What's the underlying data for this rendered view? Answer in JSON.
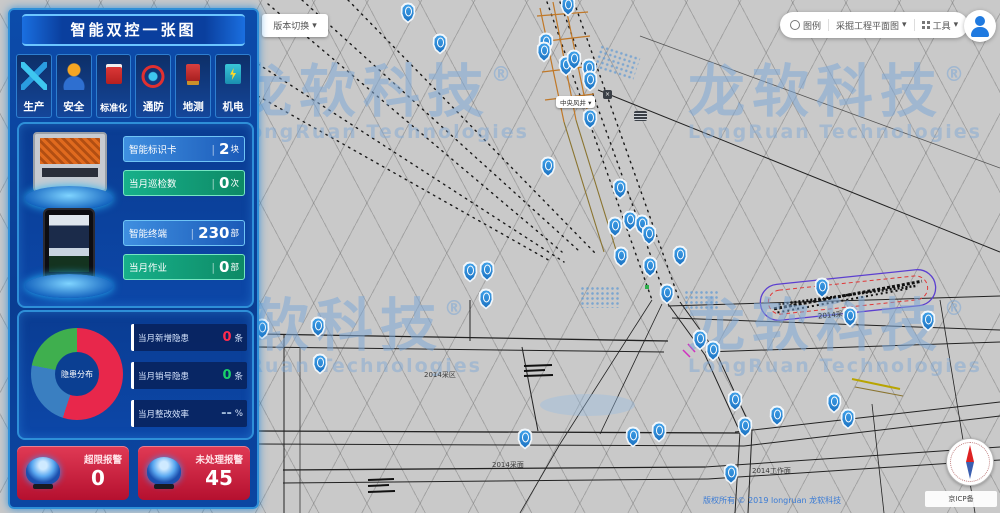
{
  "app": {
    "title": "智能双控一张图"
  },
  "sidebar": {
    "modules": [
      {
        "label": "生产",
        "icon": "production-icon"
      },
      {
        "label": "安全",
        "icon": "safety-icon"
      },
      {
        "label": "标准化",
        "icon": "standardization-icon"
      },
      {
        "label": "通防",
        "icon": "ventilation-icon"
      },
      {
        "label": "地测",
        "icon": "geology-icon"
      },
      {
        "label": "机电",
        "icon": "electromechanical-icon"
      }
    ],
    "device_stats": [
      {
        "label": "智能标识卡",
        "divider": "|",
        "value": "2",
        "unit": "块"
      },
      {
        "label": "当月巡检数",
        "divider": "|",
        "value": "0",
        "unit": "次"
      },
      {
        "label": "智能终端",
        "divider": "|",
        "value": "230",
        "unit": "部"
      },
      {
        "label": "当月作业",
        "divider": "|",
        "value": "0",
        "unit": "部"
      }
    ],
    "hazard": {
      "donut": {
        "center_label": "隐患分布",
        "segments": [
          {
            "name": "新增隐患",
            "value": 55,
            "color": "#e8274b"
          },
          {
            "name": "整改中",
            "value": 23,
            "color": "#3a7fc1"
          },
          {
            "name": "已销号",
            "value": 22,
            "color": "#3faf4e"
          }
        ]
      },
      "rows": [
        {
          "label": "当月新增隐患",
          "value": "0",
          "unit": "条",
          "color": "#ff2a4d"
        },
        {
          "label": "当月销号隐患",
          "value": "0",
          "unit": "条",
          "color": "#19d06a"
        },
        {
          "label": "当月整改效率",
          "value": "--",
          "unit": "%",
          "color": "#9fb8d8"
        }
      ]
    },
    "alarms": [
      {
        "label": "超限报警",
        "value": "0"
      },
      {
        "label": "未处理报警",
        "value": "45"
      }
    ]
  },
  "topbar": {
    "selector": "版本切换",
    "caret": "▾",
    "legend": "图例",
    "map_name": "采掘工程平面图",
    "tools": "工具"
  },
  "map": {
    "marker_label": "中央风井 ▾",
    "close_glyph": "×",
    "labels": [
      "2014采区",
      "2014采面",
      "2014采面",
      "2014工作面"
    ],
    "watermark": {
      "cn": "龙软科技",
      "reg": "®",
      "en": "LongRuan Technologies"
    },
    "copyright": "版权所有 © 2019 longruan 龙软科技",
    "icp": "京ICP备",
    "pins": [
      [
        408,
        14
      ],
      [
        440,
        45
      ],
      [
        568,
        7
      ],
      [
        546,
        44
      ],
      [
        544,
        53
      ],
      [
        566,
        67
      ],
      [
        574,
        61
      ],
      [
        589,
        70
      ],
      [
        590,
        82
      ],
      [
        590,
        120
      ],
      [
        620,
        190
      ],
      [
        548,
        168
      ],
      [
        615,
        228
      ],
      [
        630,
        222
      ],
      [
        642,
        226
      ],
      [
        649,
        236
      ],
      [
        621,
        258
      ],
      [
        650,
        268
      ],
      [
        680,
        257
      ],
      [
        667,
        295
      ],
      [
        262,
        330
      ],
      [
        318,
        328
      ],
      [
        320,
        365
      ],
      [
        470,
        273
      ],
      [
        487,
        272
      ],
      [
        486,
        300
      ],
      [
        700,
        341
      ],
      [
        713,
        352
      ],
      [
        822,
        289
      ],
      [
        850,
        318
      ],
      [
        928,
        322
      ],
      [
        525,
        440
      ],
      [
        633,
        438
      ],
      [
        659,
        433
      ],
      [
        745,
        428
      ],
      [
        731,
        475
      ],
      [
        777,
        417
      ],
      [
        735,
        402
      ],
      [
        834,
        404
      ],
      [
        848,
        420
      ]
    ]
  }
}
